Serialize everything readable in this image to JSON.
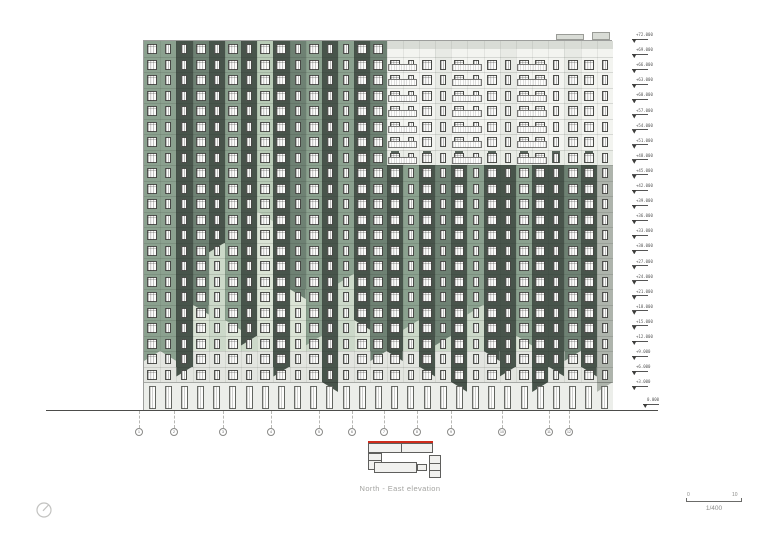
{
  "sheet": {
    "caption": "North - East elevation",
    "scalebar": {
      "left": "0",
      "right": "10",
      "ratio": "1/400"
    }
  },
  "colors": {
    "dark": "#48544b",
    "mid": "#6e8173",
    "sage": "#8ba18f",
    "mint": "#b9cbb7",
    "gray": "#aeb4ac",
    "paleA": "#ccd9c9",
    "paleB": "#dbe4d6",
    "whiteA": "#f3f4f0",
    "whiteB": "#e8eae5",
    "parapet": "#d9dcd6",
    "bottom": "#e3e5e0",
    "groundBg": "#eceeea",
    "transition": "#e9ece6",
    "transitionBlock": "#57635a",
    "line": "#5c5c5a",
    "red": "#cf2b1c"
  },
  "building": {
    "x": 143,
    "y": 40,
    "width": 469,
    "upperFloors": 22,
    "floorHeight": 15.5,
    "groundFloorHeight": 29,
    "whiteZoneFromColumn": 15,
    "whiteZoneFloors": 8
  },
  "facade": {
    "columns": [
      {
        "s": "sage",
        "e": 20,
        "c": 0,
        "w": "w"
      },
      {
        "s": "sage",
        "e": 20,
        "c": 1,
        "w": "n"
      },
      {
        "s": "dark",
        "e": 21,
        "c": 0,
        "w": "n"
      },
      {
        "s": "mid",
        "e": 17,
        "c": 1,
        "w": "w"
      },
      {
        "s": "dark",
        "e": 13,
        "c": 0,
        "w": "n"
      },
      {
        "s": "sage",
        "e": 18,
        "c": 1,
        "w": "w"
      },
      {
        "s": "dark",
        "e": 19,
        "c": 0,
        "w": "n"
      },
      {
        "s": "mint",
        "e": 11,
        "c": 1,
        "w": "w"
      },
      {
        "s": "dark",
        "e": 21,
        "c": 0,
        "w": "w"
      },
      {
        "s": "mid",
        "e": 16,
        "c": 1,
        "w": "n"
      },
      {
        "s": "sage",
        "e": 19,
        "c": 0,
        "w": "w"
      },
      {
        "s": "dark",
        "e": 22,
        "c": 1,
        "w": "n"
      },
      {
        "s": "sage",
        "e": 15,
        "c": 0,
        "w": "n"
      },
      {
        "s": "dark",
        "e": 18,
        "c": 1,
        "w": "w"
      },
      {
        "s": "mid",
        "e": 20,
        "c": 0,
        "w": "w"
      },
      {
        "s": "dark",
        "e": 20,
        "c": 1,
        "w": "w"
      },
      {
        "s": "sage",
        "e": 18,
        "c": 0,
        "w": "n"
      },
      {
        "s": "dark",
        "e": 21,
        "c": 1,
        "w": "w"
      },
      {
        "s": "mid",
        "e": 19,
        "c": 0,
        "w": "n"
      },
      {
        "s": "dark",
        "e": 22,
        "c": 1,
        "w": "w"
      },
      {
        "s": "sage",
        "e": 17,
        "c": 0,
        "w": "n"
      },
      {
        "s": "dark",
        "e": 20,
        "c": 1,
        "w": "w"
      },
      {
        "s": "dark",
        "e": 21,
        "c": 0,
        "w": "n"
      },
      {
        "s": "sage",
        "e": 19,
        "c": 1,
        "w": "w"
      },
      {
        "s": "dark",
        "e": 22,
        "c": 0,
        "w": "w"
      },
      {
        "s": "dark",
        "e": 21,
        "c": 1,
        "w": "n"
      },
      {
        "s": "mid",
        "e": 20,
        "c": 0,
        "w": "w"
      },
      {
        "s": "dark",
        "e": 21,
        "c": 1,
        "w": "w"
      },
      {
        "s": "gray",
        "e": 22,
        "c": 0,
        "w": "n"
      }
    ],
    "balconyColumnGroups": [
      15,
      19,
      23
    ],
    "roofBlocks": [
      {
        "x": 556,
        "y": 34,
        "w": 28,
        "h": 6
      },
      {
        "x": 592,
        "y": 32,
        "w": 18,
        "h": 8
      }
    ]
  },
  "levels": {
    "values": [
      "+72.000",
      "+69.000",
      "+66.000",
      "+63.000",
      "+60.000",
      "+57.000",
      "+54.000",
      "+51.000",
      "+48.000",
      "+45.000",
      "+42.000",
      "+39.000",
      "+36.000",
      "+33.000",
      "+30.000",
      "+27.000",
      "+24.000",
      "+21.000",
      "+18.000",
      "+15.000",
      "+12.000",
      "+9.000",
      "+6.000",
      "+3.000"
    ],
    "ground": "0.000"
  },
  "grid": {
    "bubbles": [
      {
        "x": 139,
        "label": "1"
      },
      {
        "x": 174,
        "label": "2"
      },
      {
        "x": 223,
        "label": "3"
      },
      {
        "x": 271,
        "label": "4"
      },
      {
        "x": 319,
        "label": "5"
      },
      {
        "x": 352,
        "label": "6"
      },
      {
        "x": 384,
        "label": "7"
      },
      {
        "x": 417,
        "label": "8"
      },
      {
        "x": 451,
        "label": "9"
      },
      {
        "x": 502,
        "label": "10"
      },
      {
        "x": 549,
        "label": "11"
      },
      {
        "x": 569,
        "label": "12"
      }
    ]
  }
}
